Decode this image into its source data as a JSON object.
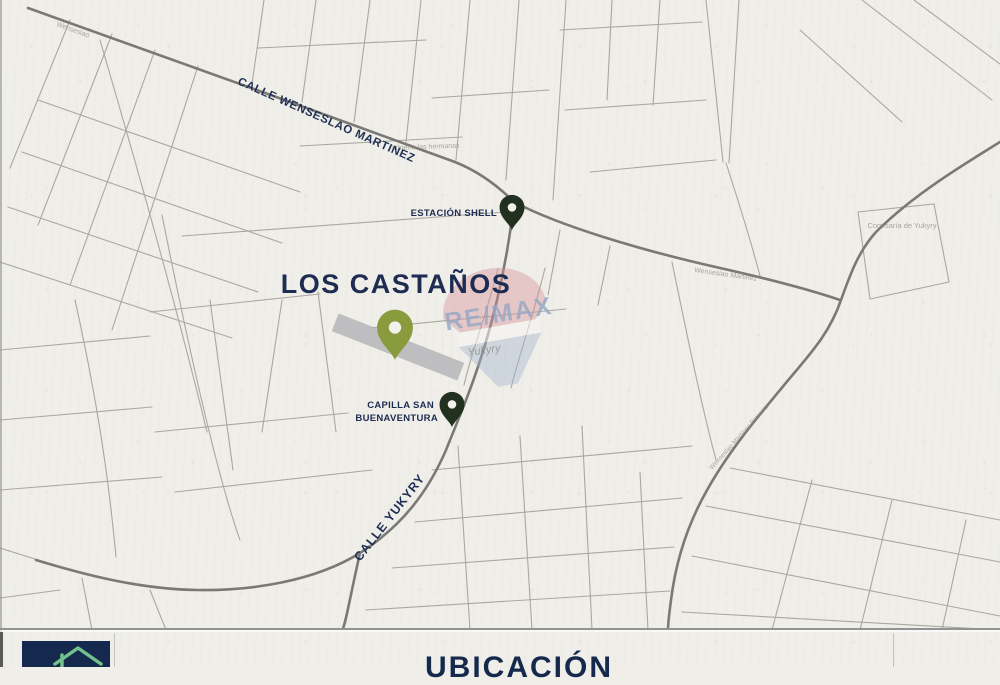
{
  "title": {
    "property": "LOS CASTAÑOS"
  },
  "roads": {
    "calle_wenseslao": "CALLE WENSESLAO MARTINEZ",
    "calle_yukyry": "CALLE YUKYRY",
    "faded_wenseslao_top": "Wenseslao",
    "faded_wenseslao_east": "Wenseslao Martinez",
    "faded_diagonal": "Wenseslao Martinez Potrerito"
  },
  "pois": {
    "shell": "ESTACIÓN SHELL",
    "capilla_line1": "CAPILLA SAN",
    "capilla_line2": "BUENAVENTURA",
    "libreria": "Librería las hermanas",
    "comisaria": "Comisaría de Yukyry",
    "region": "Yukyry"
  },
  "watermark": {
    "brand": "RE/MAX"
  },
  "footer": {
    "section_title": "UBICACIÓN"
  },
  "colors": {
    "paper": "#efeee9",
    "navy": "#1e2c52",
    "street": "#98968f",
    "main_road": "#7b7975",
    "pin_dark": "#22301f",
    "pin_olive": "#8a9b3e",
    "property_fill": "#b3b3b7",
    "footer_box": "#14294d",
    "logo_green": "#72c08c",
    "watermark_red": "#d8929c",
    "watermark_blue": "#a3b6ce"
  }
}
